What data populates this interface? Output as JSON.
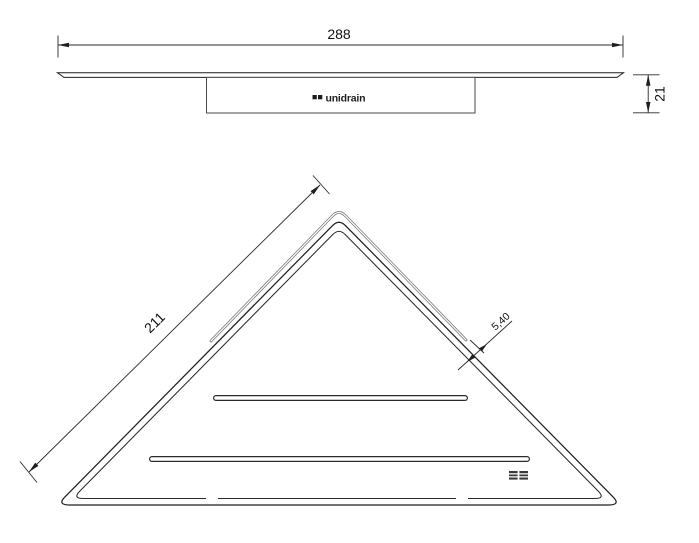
{
  "drawing": {
    "side_view": {
      "width_dim": "288",
      "height_dim": "21",
      "logo_text": "unidrain"
    },
    "plan_view": {
      "edge_dim": "211",
      "slot_offset_dim": "5,40"
    },
    "colors": {
      "line": "#1f1f1f",
      "slot_gray": "#7d7d7d",
      "background": "#ffffff"
    }
  }
}
